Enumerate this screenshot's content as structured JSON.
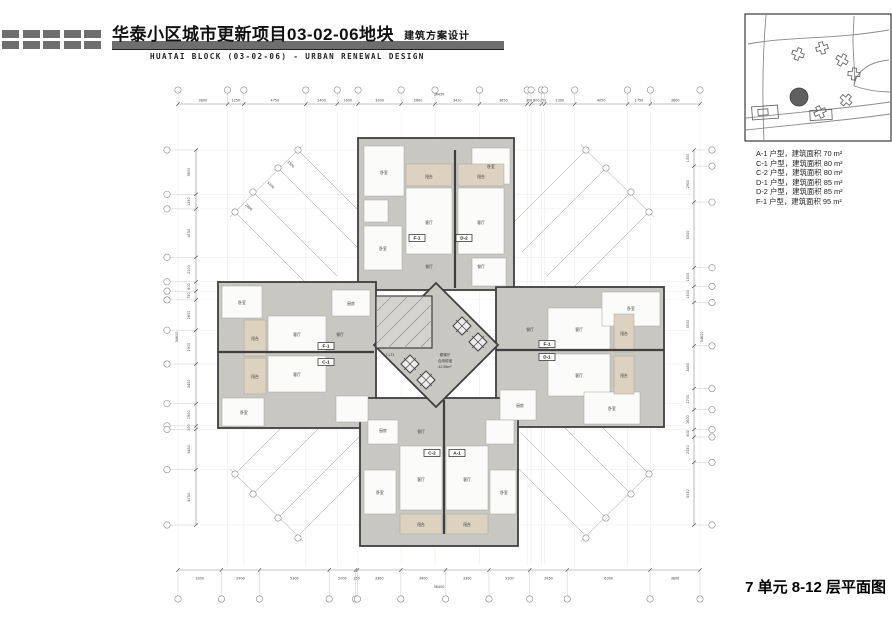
{
  "header": {
    "title_cn": "华泰小区城市更新项目03-02-06地块",
    "subtitle_cn": "建筑方案设计",
    "title_en": "HUATAI BLOCK (03-02-06) - URBAN RENEWAL DESIGN"
  },
  "legend": {
    "items": [
      "A-1 户型，建筑面积 70 m²",
      "C-1 户型，建筑面积 80 m²",
      "C-2 户型，建筑面积 80 m²",
      "D-1 户型，建筑面积 85 m²",
      "D-2 户型，建筑面积 85 m²",
      "F-1 户型，建筑面积 95 m²"
    ]
  },
  "caption": "7 单元 8-12 层平面图",
  "plan": {
    "dims": {
      "top": {
        "values": [
          "3800",
          "1250",
          "4750",
          "2400",
          "1600",
          "3300",
          "2600",
          "3410",
          "3650",
          "300",
          "800",
          "250",
          "2300",
          "4050",
          "1750",
          "3800"
        ],
        "total": "36450"
      },
      "bottom": {
        "values": [
          "3300",
          "2900",
          "5300",
          "2000",
          "150",
          "3300",
          "3400",
          "3300",
          "3100",
          "2850",
          "6300",
          "3800"
        ],
        "total": "36450"
      },
      "left": {
        "values": [
          "3800",
          "1250",
          "4150",
          "2100",
          "800",
          "750",
          "2600",
          "2900",
          "3400",
          "1900",
          "300",
          "3450",
          "4750"
        ],
        "total": "34600"
      },
      "right": {
        "values": [
          "1300",
          "2900",
          "5300",
          "1500",
          "1300",
          "3500",
          "3450",
          "1700",
          "1600",
          "600",
          "2050",
          "5050"
        ],
        "total": "34600"
      },
      "diagonal_top_left": [
        "3300",
        "5200",
        "2800"
      ]
    },
    "unit_tags": [
      {
        "label": "F-1",
        "x": 417,
        "y": 238
      },
      {
        "label": "D-2",
        "x": 464,
        "y": 238
      },
      {
        "label": "F-1",
        "x": 326,
        "y": 346
      },
      {
        "label": "C-1",
        "x": 326,
        "y": 362
      },
      {
        "label": "F-1",
        "x": 547,
        "y": 344
      },
      {
        "label": "D-1",
        "x": 547,
        "y": 357
      },
      {
        "label": "C-2",
        "x": 432,
        "y": 453
      },
      {
        "label": "A-1",
        "x": 457,
        "y": 453
      }
    ],
    "room_labels": [
      {
        "t": "阳台",
        "x": 429,
        "y": 178
      },
      {
        "t": "阳台",
        "x": 481,
        "y": 178
      },
      {
        "t": "客厅",
        "x": 429,
        "y": 224
      },
      {
        "t": "客厅",
        "x": 481,
        "y": 224
      },
      {
        "t": "卧室",
        "x": 384,
        "y": 174
      },
      {
        "t": "卧室",
        "x": 383,
        "y": 250
      },
      {
        "t": "卧室",
        "x": 491,
        "y": 168
      },
      {
        "t": "餐厅",
        "x": 429,
        "y": 268
      },
      {
        "t": "餐厅",
        "x": 481,
        "y": 268
      },
      {
        "t": "阳台",
        "x": 255,
        "y": 340
      },
      {
        "t": "阳台",
        "x": 255,
        "y": 378
      },
      {
        "t": "客厅",
        "x": 297,
        "y": 336
      },
      {
        "t": "客厅",
        "x": 297,
        "y": 376
      },
      {
        "t": "卧室",
        "x": 242,
        "y": 304
      },
      {
        "t": "卧室",
        "x": 244,
        "y": 414
      },
      {
        "t": "餐厅",
        "x": 340,
        "y": 336
      },
      {
        "t": "厨房",
        "x": 351,
        "y": 305
      },
      {
        "t": "阳台",
        "x": 624,
        "y": 335
      },
      {
        "t": "阳台",
        "x": 624,
        "y": 377
      },
      {
        "t": "客厅",
        "x": 579,
        "y": 331
      },
      {
        "t": "客厅",
        "x": 579,
        "y": 377
      },
      {
        "t": "卧室",
        "x": 631,
        "y": 310
      },
      {
        "t": "卧室",
        "x": 612,
        "y": 410
      },
      {
        "t": "餐厅",
        "x": 530,
        "y": 331
      },
      {
        "t": "厨房",
        "x": 520,
        "y": 407
      },
      {
        "t": "阳台",
        "x": 421,
        "y": 526
      },
      {
        "t": "阳台",
        "x": 467,
        "y": 526
      },
      {
        "t": "客厅",
        "x": 421,
        "y": 481
      },
      {
        "t": "客厅",
        "x": 467,
        "y": 481
      },
      {
        "t": "卧室",
        "x": 380,
        "y": 494
      },
      {
        "t": "卧室",
        "x": 504,
        "y": 494
      },
      {
        "t": "餐厅",
        "x": 421,
        "y": 433
      },
      {
        "t": "厨房",
        "x": 383,
        "y": 432
      }
    ],
    "core": {
      "lobby_line1": "候梯厅",
      "lobby_line2": "合用前室",
      "lobby_area": "42.55m²",
      "stair_label": "7-LT1"
    }
  },
  "colors": {
    "wall": "#3f3f3f",
    "floor": "#c8c7c2",
    "balcony": "#ddd2bf",
    "accent_bar": "#6e6e6e"
  }
}
